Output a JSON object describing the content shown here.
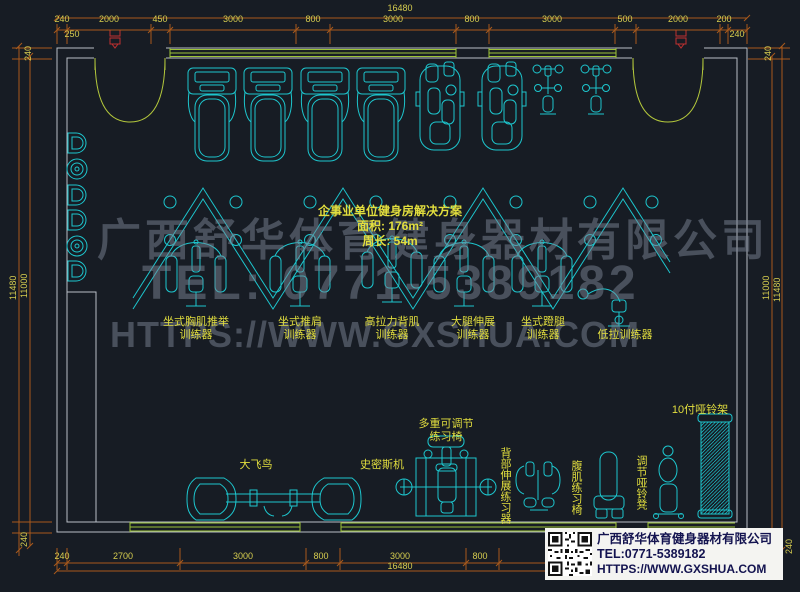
{
  "plan_title": {
    "line1": "企事业单位健身房解决方案",
    "line2": "面积: 176m²",
    "line3": "周长: 54m"
  },
  "watermark": {
    "line1": "广西舒华体育健身器材有限公司",
    "line2": "TEL: 0771-5389182",
    "line3": "HTTPS://WWW.GXSHUA.COM"
  },
  "info_box": {
    "company": "广西舒华体育健身器材有限公司",
    "tel": "TEL:0771-5389182",
    "url": "HTTPS://WWW.GXSHUA.COM"
  },
  "dimensions": {
    "top": {
      "total": "16480",
      "segments": [
        "240",
        "2000",
        "450",
        "3000",
        "800",
        "3000",
        "800",
        "3000",
        "500",
        "2000",
        "200"
      ],
      "sub_left": "250",
      "sub_right": "240"
    },
    "bottom": {
      "total": "16480",
      "segments": [
        "240",
        "2700",
        "3000",
        "800",
        "3000",
        "800"
      ]
    },
    "left": {
      "total": "11480",
      "inner": "11000",
      "wall_top": "240",
      "wall_bottom": "240"
    },
    "right": {
      "total": "11480",
      "inner": "11000",
      "wall_top": "240",
      "wall_bottom": "240"
    }
  },
  "equipment_labels": {
    "chest_press": {
      "l1": "坐式胸肌推举",
      "l2": "训练器"
    },
    "shoulder_press": {
      "l1": "坐式推肩",
      "l2": "训练器"
    },
    "lat_pulldown": {
      "l1": "高拉力背肌",
      "l2": "训练器"
    },
    "leg_extension": {
      "l1": "大腿伸展",
      "l2": "训练器"
    },
    "leg_press": {
      "l1": "坐式蹬腿",
      "l2": "训练器"
    },
    "low_pull": "低拉训练器",
    "fly": "大飞鸟",
    "smith": "史密斯机",
    "adjustable_bench": {
      "l1": "多重可调节",
      "l2": "练习椅"
    },
    "back_extension": "背部伸展练习器",
    "ab_bench": "腹肌练习椅",
    "dumbbell_stool": "调节哑铃凳",
    "dumbbell_rack": "10付哑铃架"
  },
  "colors": {
    "background": "#171c24",
    "equipment": "#1dc6ce",
    "wall": "#b8bec6",
    "window": "#9dc437",
    "door": "#b4c83c",
    "dimension_line": "#a8591c",
    "dimension_text": "#d6cd4f",
    "label_text": "#e2de3e",
    "watermark": "#7b8595",
    "door_tag": "#c03030",
    "info_text": "#141450"
  }
}
